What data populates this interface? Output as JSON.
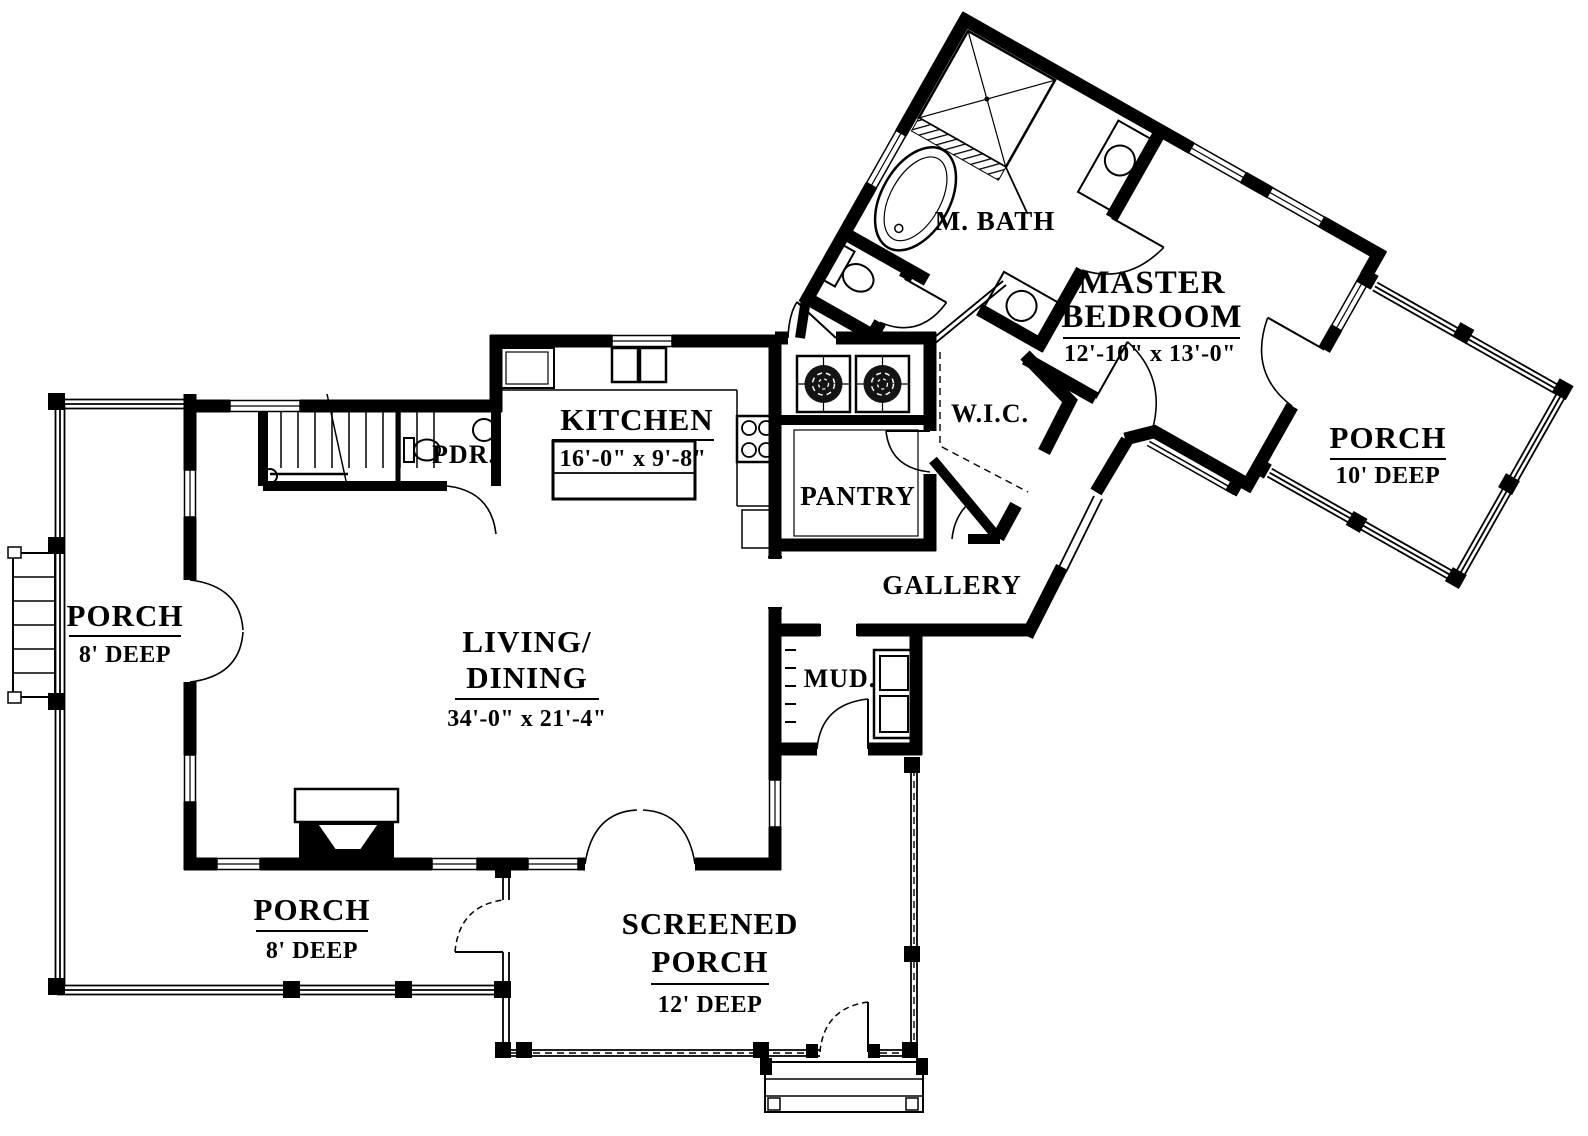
{
  "plan": {
    "title": "First floor house plan",
    "rooms": {
      "kitchen": {
        "name": "KITCHEN",
        "dims": "16'-0\" x 9'-8\""
      },
      "living_dining": {
        "name_line1": "LIVING/",
        "name_line2": "DINING",
        "dims": "34'-0\" x 21'-4\""
      },
      "master_bedroom": {
        "name_line1": "MASTER",
        "name_line2": "BEDROOM",
        "dims": "12'-10\" x 13'-0\""
      },
      "master_bath": {
        "name": "M. BATH"
      },
      "walk_in_closet": {
        "name": "W.I.C."
      },
      "pantry": {
        "name": "PANTRY"
      },
      "gallery": {
        "name": "GALLERY"
      },
      "mud_room": {
        "name": "MUD."
      },
      "powder_room": {
        "name": "PDR."
      },
      "porch_left": {
        "name": "PORCH",
        "dims": "8' DEEP"
      },
      "porch_bottom": {
        "name": "PORCH",
        "dims": "8' DEEP"
      },
      "porch_master": {
        "name": "PORCH",
        "dims": "10' DEEP"
      },
      "screened_porch": {
        "name_line1": "SCREENED",
        "name_line2": "PORCH",
        "dims": "12' DEEP"
      }
    },
    "colors": {
      "wall": "#000000",
      "background": "#ffffff"
    }
  }
}
